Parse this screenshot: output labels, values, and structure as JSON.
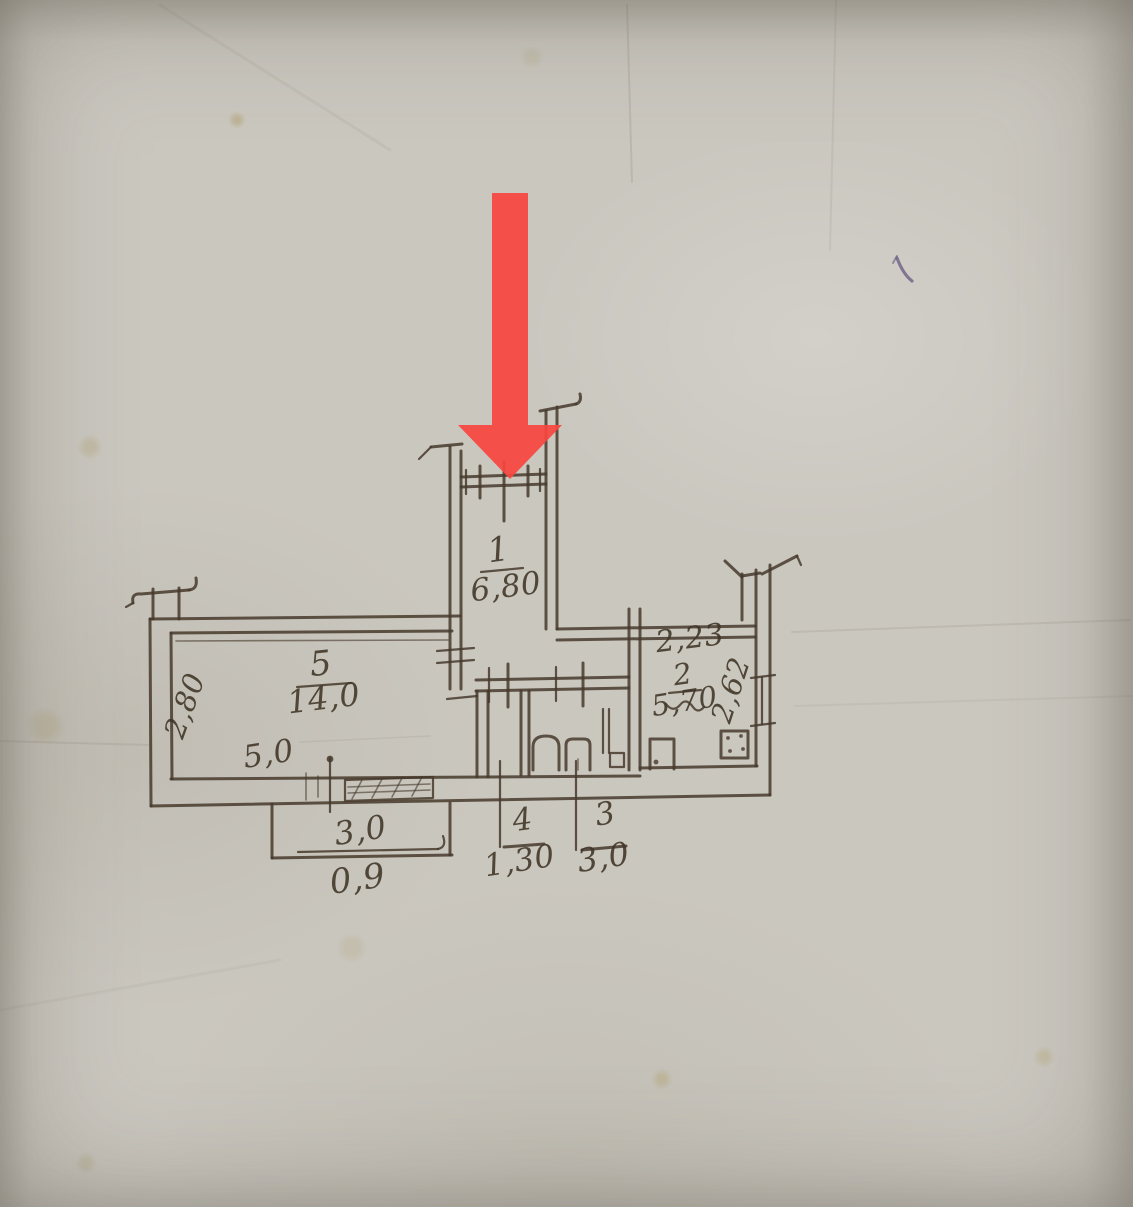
{
  "document": {
    "kind": "hand-drawn apartment floor plan on aged paper",
    "paper_color": "#cac7bf",
    "ink_color": "#46392c"
  },
  "annotation_arrow": {
    "color": "#f8473f",
    "points_to": "window at top of room 1"
  },
  "rooms": [
    {
      "number": "1",
      "area": "6,80"
    },
    {
      "number": "2",
      "area": "5,70",
      "dim_width": "2,23",
      "dim_depth": "2,62"
    },
    {
      "number": "3",
      "dim": "3,0"
    },
    {
      "number": "4",
      "dim": "1,30"
    },
    {
      "number": "5",
      "area": "14,0",
      "dim_depth": "2,80",
      "dim_width": "5,0"
    }
  ],
  "balcony": {
    "dim_width": "3,0",
    "dim_depth": "0,9"
  }
}
